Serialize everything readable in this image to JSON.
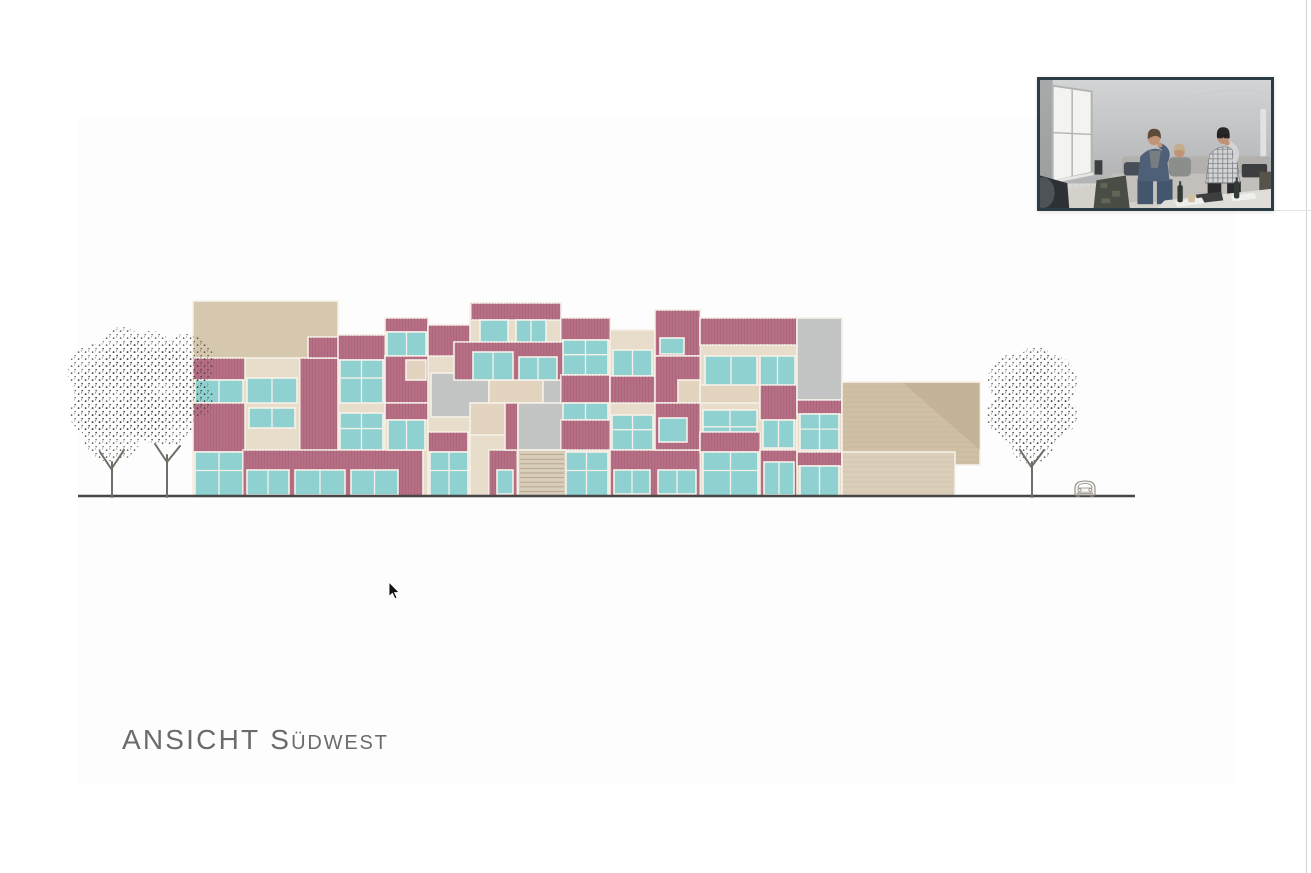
{
  "page": {
    "bg": "#ffffff",
    "slide_bg": "#fdfdfd"
  },
  "title": {
    "part1": "ANSICHT",
    "part2_initial": "S",
    "part2_rest": "ÜDWEST",
    "color": "#6b6b6e"
  },
  "drawing": {
    "ground_line": {
      "x1": 78,
      "y": 496,
      "x2": 1135,
      "color": "#474747"
    },
    "palette": {
      "cream": "#e8ddcb",
      "cream2": "#e2d4bf",
      "beigeTop": "#d6c7af",
      "pink": "#b66f85",
      "pinkStripe": "#9a5870",
      "teal": "#8ed1d0",
      "gray": "#c3c5c5",
      "frame": "#f6f1e8",
      "wing": "#cfbfa4",
      "wingDark": "#b4a183",
      "wingFront": "#dbcfba",
      "wingLine": "#b9a88c",
      "stairFill": "#d8cdbb",
      "stairLine": "#ab9878",
      "trunk": "#6f6f68",
      "treeInk": "#3f3f3b",
      "carInk": "#8f8b82"
    },
    "facade_blocks": [
      [
        "cream",
        193,
        358,
        145,
        139
      ],
      [
        "cream",
        338,
        335,
        47,
        162
      ],
      [
        "cream",
        385,
        318,
        43,
        179
      ],
      [
        "cream",
        428,
        325,
        42,
        172
      ],
      [
        "cream",
        470,
        303,
        91,
        194
      ],
      [
        "cream",
        561,
        318,
        49,
        179
      ],
      [
        "cream",
        610,
        330,
        45,
        167
      ],
      [
        "cream",
        655,
        310,
        45,
        187
      ],
      [
        "cream",
        700,
        318,
        97,
        179
      ],
      [
        "cream",
        797,
        318,
        45,
        179
      ],
      [
        "beigeTop",
        193,
        301,
        145,
        57
      ],
      [
        "pink",
        193,
        358,
        52,
        22
      ],
      [
        "teal",
        195,
        380,
        48,
        23
      ],
      [
        "pink",
        193,
        403,
        52,
        49
      ],
      [
        "teal",
        195,
        452,
        48,
        44
      ],
      [
        "teal",
        247,
        378,
        50,
        25
      ],
      [
        "teal",
        249,
        408,
        46,
        20
      ],
      [
        "pink",
        300,
        358,
        38,
        94
      ],
      [
        "pink",
        308,
        337,
        60,
        21
      ],
      [
        "pink",
        338,
        335,
        47,
        25
      ],
      [
        "teal",
        340,
        360,
        43,
        43
      ],
      [
        "teal",
        340,
        413,
        43,
        37
      ],
      [
        "pink",
        243,
        450,
        180,
        46
      ],
      [
        "teal",
        247,
        470,
        42,
        25
      ],
      [
        "teal",
        295,
        470,
        50,
        25
      ],
      [
        "teal",
        351,
        470,
        47,
        25
      ],
      [
        "pink",
        385,
        318,
        43,
        14
      ],
      [
        "teal",
        387,
        332,
        39,
        24
      ],
      [
        "pink",
        385,
        356,
        43,
        47
      ],
      [
        "cream2",
        406,
        360,
        20,
        20
      ],
      [
        "pink",
        385,
        403,
        43,
        17
      ],
      [
        "teal",
        388,
        420,
        37,
        30
      ],
      [
        "pink",
        428,
        325,
        42,
        31
      ],
      [
        "gray",
        431,
        373,
        58,
        44
      ],
      [
        "cream2",
        489,
        373,
        54,
        30
      ],
      [
        "gray",
        543,
        366,
        60,
        40
      ],
      [
        "cream2",
        470,
        403,
        73,
        32
      ],
      [
        "gray",
        543,
        406,
        55,
        29
      ],
      [
        "pink",
        471,
        303,
        90,
        17
      ],
      [
        "teal",
        480,
        320,
        28,
        24
      ],
      [
        "teal",
        516,
        320,
        30,
        24
      ],
      [
        "pink",
        454,
        342,
        133,
        38
      ],
      [
        "teal",
        473,
        352,
        40,
        28
      ],
      [
        "teal",
        519,
        357,
        38,
        23
      ],
      [
        "pink",
        428,
        432,
        40,
        20
      ],
      [
        "teal",
        430,
        452,
        38,
        44
      ],
      [
        "pink",
        489,
        450,
        28,
        46
      ],
      [
        "teal",
        497,
        470,
        16,
        24
      ],
      [
        "pink",
        505,
        403,
        13,
        47
      ],
      [
        "gray",
        518,
        403,
        48,
        47
      ],
      [
        "pink",
        566,
        403,
        14,
        47
      ],
      [
        "pink",
        561,
        318,
        49,
        22
      ],
      [
        "teal",
        563,
        340,
        45,
        35
      ],
      [
        "pink",
        561,
        375,
        49,
        28
      ],
      [
        "teal",
        563,
        403,
        45,
        17
      ],
      [
        "pink",
        561,
        420,
        49,
        30
      ],
      [
        "teal",
        565,
        452,
        43,
        44
      ],
      [
        "teal",
        613,
        350,
        39,
        26
      ],
      [
        "pink",
        610,
        376,
        45,
        27
      ],
      [
        "teal",
        612,
        415,
        41,
        35
      ],
      [
        "pink",
        610,
        450,
        90,
        46
      ],
      [
        "teal",
        614,
        470,
        36,
        24
      ],
      [
        "teal",
        658,
        470,
        38,
        24
      ],
      [
        "pink",
        655,
        310,
        45,
        46
      ],
      [
        "teal",
        660,
        338,
        24,
        16
      ],
      [
        "pink",
        655,
        356,
        45,
        47
      ],
      [
        "cream2",
        678,
        380,
        22,
        23
      ],
      [
        "pink",
        655,
        403,
        45,
        47
      ],
      [
        "teal",
        659,
        418,
        28,
        24
      ],
      [
        "pink",
        700,
        318,
        97,
        27
      ],
      [
        "teal",
        705,
        356,
        52,
        30
      ],
      [
        "teal",
        760,
        356,
        35,
        30
      ],
      [
        "cream2",
        700,
        385,
        60,
        18
      ],
      [
        "teal",
        703,
        410,
        54,
        40
      ],
      [
        "pink",
        760,
        385,
        37,
        35
      ],
      [
        "teal",
        763,
        420,
        31,
        28
      ],
      [
        "pink",
        700,
        432,
        60,
        20
      ],
      [
        "teal",
        703,
        452,
        55,
        44
      ],
      [
        "pink",
        760,
        450,
        37,
        46
      ],
      [
        "teal",
        764,
        462,
        30,
        33
      ],
      [
        "gray",
        797,
        318,
        45,
        82
      ],
      [
        "pink",
        797,
        400,
        45,
        14
      ],
      [
        "teal",
        800,
        414,
        39,
        36
      ],
      [
        "pink",
        797,
        452,
        45,
        14
      ],
      [
        "teal",
        800,
        466,
        39,
        30
      ]
    ],
    "wing": {
      "x": 842,
      "y": 382,
      "w": 138,
      "h": 83,
      "diag_points": "903,383 980,383 980,450",
      "front": {
        "x": 842,
        "y": 452,
        "w": 113,
        "h": 45
      }
    },
    "stair": {
      "x": 518,
      "y": 450,
      "w": 48,
      "h": 46,
      "steps": 9
    },
    "trees": [
      {
        "trunk": "M112,497 L112,462 M112,470 L100,452 M112,468 L124,450",
        "canopy": [
          [
            114,
            398,
            40
          ],
          [
            96,
            372,
            28
          ],
          [
            132,
            368,
            27
          ],
          [
            112,
            432,
            30
          ],
          [
            140,
            412,
            24
          ],
          [
            90,
            414,
            20
          ],
          [
            122,
            347,
            20
          ]
        ]
      },
      {
        "trunk": "M167,497 L167,455 M167,462 L155,444 M167,462 L180,446",
        "canopy": [
          [
            167,
            388,
            40
          ],
          [
            150,
            358,
            27
          ],
          [
            186,
            362,
            28
          ],
          [
            168,
            420,
            26
          ],
          [
            194,
            398,
            20
          ],
          [
            152,
            425,
            18
          ]
        ]
      },
      {
        "trunk": "M1032,497 L1032,462 M1032,468 L1020,450 M1032,466 L1044,450",
        "canopy": [
          [
            1032,
            410,
            40
          ],
          [
            1014,
            380,
            26
          ],
          [
            1050,
            382,
            27
          ],
          [
            1032,
            442,
            22
          ],
          [
            1060,
            416,
            18
          ],
          [
            1004,
            416,
            18
          ],
          [
            1036,
            362,
            16
          ]
        ]
      }
    ],
    "car": {
      "x": 1072,
      "y": 479
    }
  },
  "cursor": {
    "x": 389,
    "y": 582
  },
  "webcam": {
    "x": 1037,
    "y": 77,
    "w": 237,
    "h": 134,
    "border_color": "#2c3c46",
    "colors": {
      "wallTop": "#d3d4d6",
      "wallBottom": "#a9abad",
      "wallShade": "#909294",
      "window": "#f3f4f2",
      "windowFrame": "#b3b4b2",
      "radiator": "#d8d9d7",
      "floor": "#d4d1ca",
      "couch": "#c3c0bb",
      "couchBack": "#b2b0ac",
      "darkCouch": "#2e3134",
      "shoulder": "#4e5358",
      "camo": "#4a4d45",
      "skin": "#c09376",
      "hairA": "#5d4b3a",
      "shirtA": "#4e6077",
      "teeA": "#777d80",
      "jeans": "#44566e",
      "hairB": "#c3ad8d",
      "shirtB": "#8c8e8c",
      "hairC": "#292725",
      "shirtC": "#d3d4d6",
      "plaidLine": "#5d6268",
      "pants": "#2b2b2d",
      "dark": "#3c3e40",
      "bottle": "#323b36",
      "cup": "#cfc2a0",
      "paper": "#efefed",
      "table": "#dfddd8"
    }
  },
  "artifacts": {
    "right_vline_x": 1306,
    "right_vline_color": "#d2d2d2",
    "below_video_hline_y": 210,
    "below_video_hline_x1": 1274,
    "below_video_hline_x2": 1311,
    "below_video_hline_color": "#e3e3e3"
  }
}
